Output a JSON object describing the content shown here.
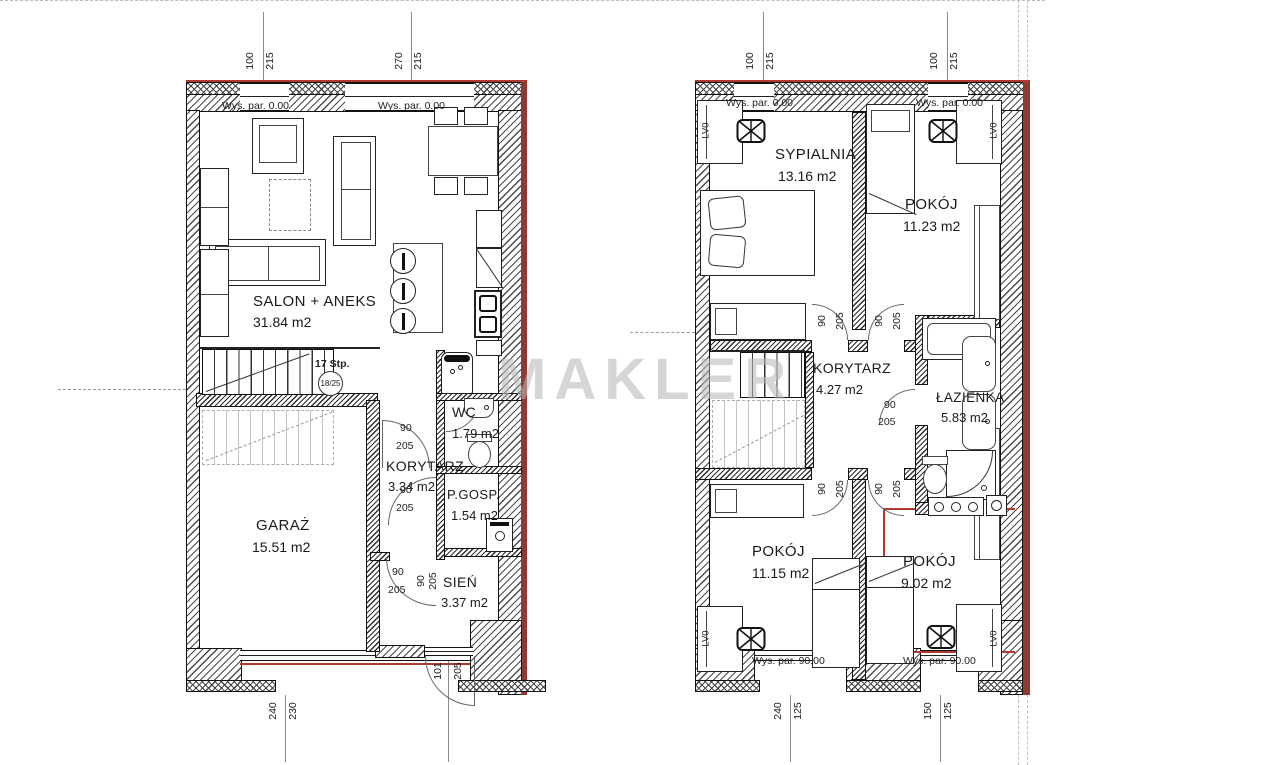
{
  "watermark": "MAKLER",
  "ground": {
    "level1": "Wys. par. 0.00",
    "level2": "Wys. par. 0.00",
    "salon_name": "SALON + ANEKS",
    "salon_area": "31.84 m2",
    "garaz_name": "GARAŻ",
    "garaz_area": "15.51 m2",
    "korytarz_name": "KORYTARZ",
    "korytarz_area": "3.34 m2",
    "wc_name": "WC",
    "wc_area": "1.79 m2",
    "pgosp_name": "P.GOSP.",
    "pgosp_area": "1.54 m2",
    "sien_name": "SIEŃ",
    "sien_area": "3.37 m2",
    "stairs_label": "17 Stp.",
    "stairs_ratio": "18/25",
    "dim_win1_w": "100",
    "dim_win1_h": "215",
    "dim_win2_w": "270",
    "dim_win2_h": "215",
    "dim_garage_w": "240",
    "dim_garage_h": "230",
    "dim_entry_w": "101",
    "dim_entry_h": "205",
    "dim_door_w": "90",
    "dim_door_h": "205"
  },
  "upper": {
    "level1": "Wys. par. 0.00",
    "level2": "Wys. par. 0.00",
    "level3": "Wys. par. 90.00",
    "level4": "Wys. par. 90.00",
    "sypialnia_name": "SYPIALNIA",
    "sypialnia_area": "13.16 m2",
    "pokoj1_name": "POKÓJ",
    "pokoj1_area": "11.23 m2",
    "korytarz_name": "KORYTARZ",
    "korytarz_area": "4.27 m2",
    "lazienka_name": "ŁAZIENKA",
    "lazienka_area": "5.83 m2",
    "pokoj2_name": "POKÓJ",
    "pokoj2_area": "11.15 m2",
    "pokoj3_name": "POKÓJ",
    "pokoj3_area": "9.02 m2",
    "radiator": "LV0",
    "dim_win_w": "100",
    "dim_win_h": "215",
    "dim_b1_w": "240",
    "dim_b1_h": "125",
    "dim_b2_w": "150",
    "dim_b2_h": "125",
    "dim_door_w": "90",
    "dim_door_h": "205"
  }
}
